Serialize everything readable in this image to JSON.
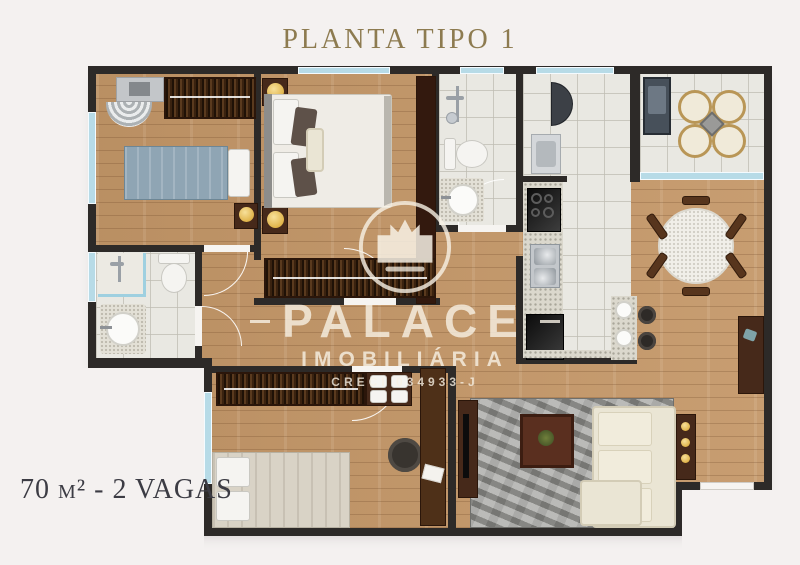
{
  "title": "PLANTA TIPO 1",
  "watermark": {
    "brand": "PALACE",
    "subtitle": "IMOBILIÁRIA",
    "license": "CRECI 034933-J"
  },
  "footer": {
    "area_label": "70 m² - 2 VAGAS"
  },
  "colors": {
    "background": "#f4f1f0",
    "wall": "#2d2a28",
    "wood_floor": "#c49768",
    "tile_floor": "#e9e8e2",
    "window_glass": "#b7dbe7",
    "title_text": "#8d7b50",
    "footer_text": "#3c3c44",
    "watermark_text": "#f6f0e4",
    "gold_accent": "#e8c766"
  },
  "icons": {
    "crown-icon": "crown inside circle (brand logo)",
    "lamp-icon": "gold bedside lamp (circle)",
    "grill-icon": "balcony barbecue grill",
    "shower-icon": "shower fixture"
  }
}
